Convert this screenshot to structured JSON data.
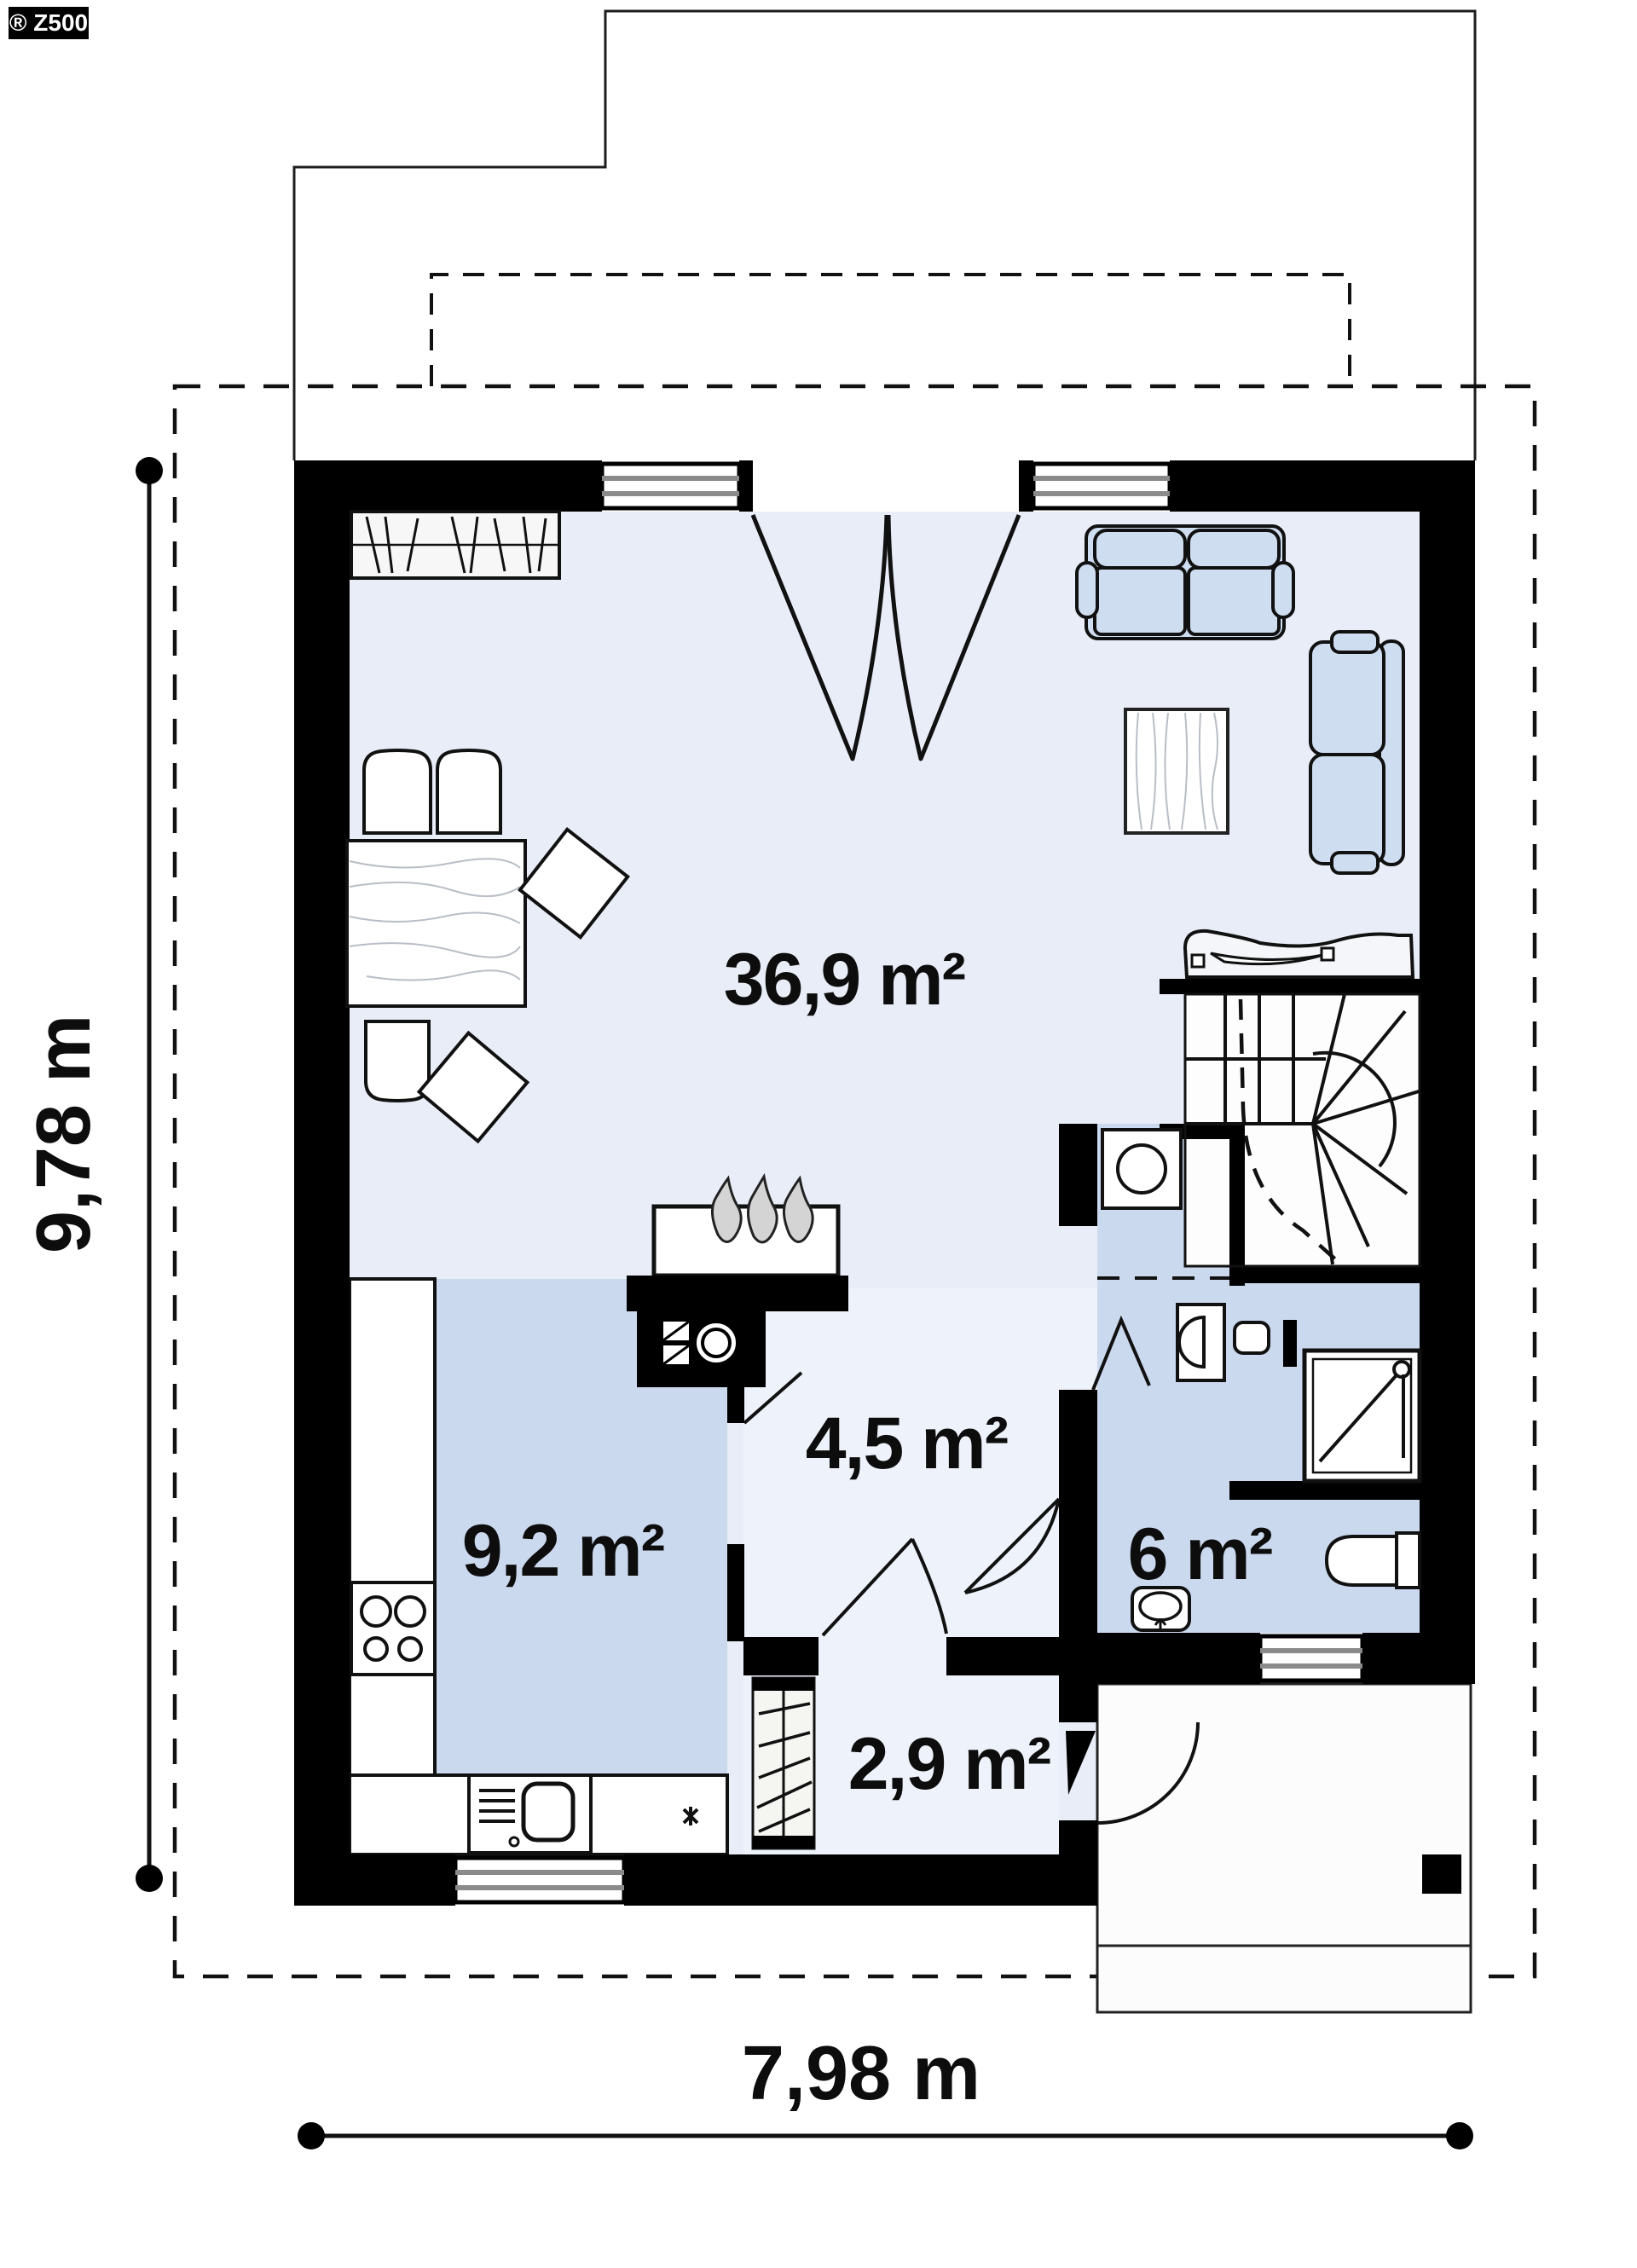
{
  "logo": {
    "text": "® Z500"
  },
  "rooms": [
    {
      "id": "living-dining",
      "label": "36,9 m²"
    },
    {
      "id": "kitchen",
      "label": "9,2 m²"
    },
    {
      "id": "hall",
      "label": "4,5 m²"
    },
    {
      "id": "bathroom",
      "label": "6 m²"
    },
    {
      "id": "vestibule",
      "label": "2,9 m²"
    }
  ],
  "dimensions": {
    "overall_width": "7,98 m",
    "overall_height": "9,78 m"
  },
  "colors": {
    "living": "#e8edf7",
    "hall": "#eef2fa",
    "vestibule": "#eef2fa",
    "wet": "#cbd9ef",
    "stairs": "#fdfdfd",
    "porch": "#fcfcfc",
    "wall": "#000000",
    "glass": "#8a8a8a"
  }
}
